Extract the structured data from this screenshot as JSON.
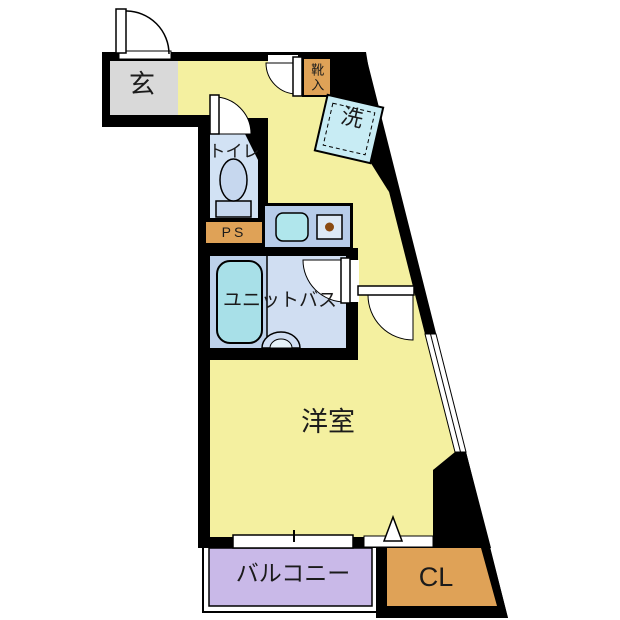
{
  "plan": {
    "type": "apartment-floor-plan",
    "rooms": {
      "genkan": {
        "label": "玄"
      },
      "shoe_box": {
        "label": "靴入"
      },
      "washer": {
        "label": "洗"
      },
      "toilet": {
        "label": "トイレ"
      },
      "pipe_space": {
        "label": "PS"
      },
      "unit_bath": {
        "label": "ユニットバス"
      },
      "main_room": {
        "label": "洋室"
      },
      "balcony": {
        "label": "バルコニー"
      },
      "closet": {
        "label": "CL"
      }
    },
    "colors": {
      "wall": "#000000",
      "floor": "#f4f0a0",
      "genkan": "#d9d9d9",
      "orange": "#dfa257",
      "balcony": "#c9b9e8",
      "toiletFloor": "#d2e2f4",
      "fixture": "#c6d7ee",
      "kitchen": "#b7cce9",
      "sink": "#b0e6ec",
      "burner": "#dde9f6",
      "burnerDot": "#8a4a12",
      "bathLeft": "#bdd1ea",
      "bathRight": "#d0def2",
      "tub": "#a8e0e8",
      "washer": "#c8ecf4",
      "text": "#1b1b1b"
    }
  }
}
